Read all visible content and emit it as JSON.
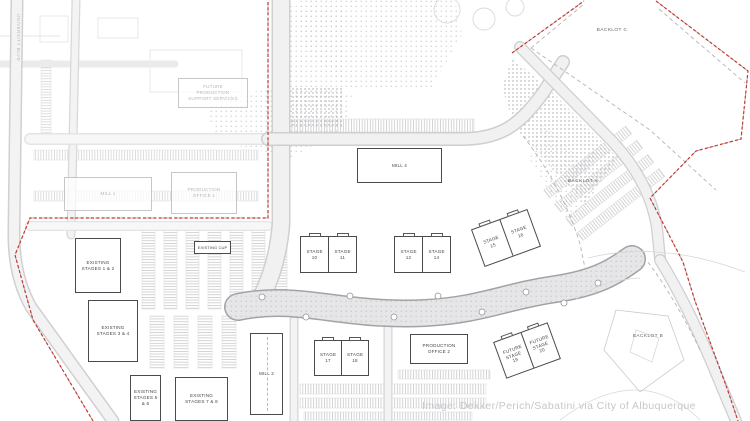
{
  "canvas": {
    "width": 750,
    "height": 421
  },
  "colors": {
    "boundary_dash": "#c8352c",
    "building_outline": "#4a4a4e",
    "faded_outline": "#c6c6ca",
    "road_fill": "#ececee",
    "label_text": "#46464a",
    "watermark_text": "#c7c7c9"
  },
  "labels": {
    "future_support": "FUTURE PRODUCTION SUPPORT SERVICES",
    "mill_1": "MILL 1",
    "production_office_1": "PRODUCTION OFFICE 1",
    "mill_2": "MILL 2",
    "mill_4": "MILL 4",
    "stage_10": "STAGE 10",
    "stage_11": "STAGE 11",
    "stage_12": "STAGE 12",
    "stage_14": "STAGE 14",
    "stage_15": "STAGE 15",
    "stage_16": "STAGE 16",
    "stage_17": "STAGE 17",
    "stage_18": "STAGE 18",
    "future_stage_19": "FUTURE STAGE 19",
    "future_stage_20": "FUTURE STAGE 20",
    "production_office_2": "PRODUCTION OFFICE 2",
    "existing_cup": "EXISTING CUP",
    "existing_stages_1_2": "EXISTING STAGES 1 & 2",
    "existing_stages_3_4": "EXISTING STAGES 3 & 4",
    "existing_stages_5_6": "EXISTING STAGES 5 & 6",
    "existing_stages_7_8": "EXISTING STAGES 7 & 8",
    "backlot_a": "BACKLOT A",
    "backlot_b": "BACKLOT B",
    "backlot_c": "BACKLOT C",
    "street_west": "UNIVERSITY BLVD"
  },
  "credit": "Image: Dekker/Perich/Sabatini via City of Albuquerque"
}
